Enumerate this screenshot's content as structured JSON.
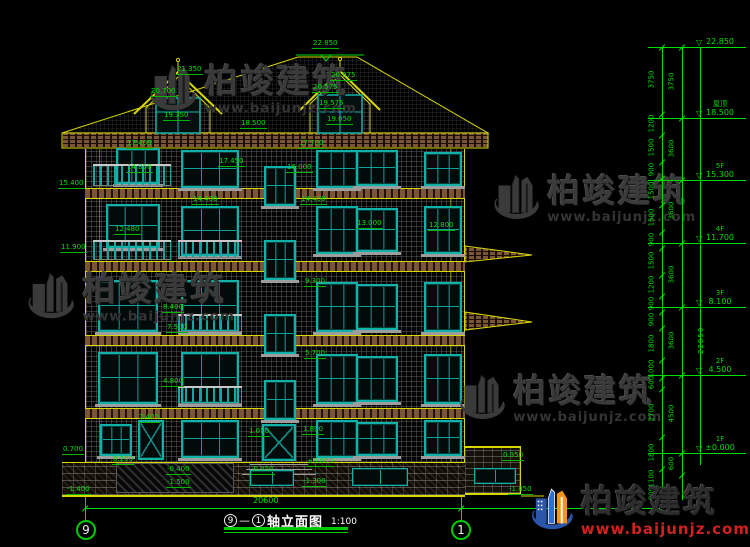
{
  "brand": {
    "name": "柏竣建筑",
    "url": "www.baijunjz.com"
  },
  "title": {
    "axis_from": "9",
    "dash": "—",
    "axis_to": "1",
    "text": "轴立面图",
    "scale": "1:100"
  },
  "axis_bubbles": {
    "left": "9",
    "right": "1"
  },
  "dimensions": {
    "total": "22850",
    "bottom_total": "20600",
    "levels": [
      {
        "floor": "",
        "elev": "22.850",
        "y": 47
      },
      {
        "floor": "屋顶",
        "elev": "18.500",
        "y": 118
      },
      {
        "floor": "5F",
        "elev": "15.300",
        "y": 180
      },
      {
        "floor": "4F",
        "elev": "11.700",
        "y": 243
      },
      {
        "floor": "3F",
        "elev": "8.100",
        "y": 307
      },
      {
        "floor": "2F",
        "elev": "4.500",
        "y": 375
      },
      {
        "floor": "1F",
        "elev": "±0.000",
        "y": 453
      }
    ],
    "col1": {
      "x": 662,
      "labels": [
        [
          "3750",
          80
        ],
        [
          "1200",
          124
        ],
        [
          "1500",
          148
        ],
        [
          "900",
          170
        ],
        [
          "1500",
          191
        ],
        [
          "1500",
          218
        ],
        [
          "900",
          240
        ],
        [
          "1500",
          261
        ],
        [
          "1200",
          285
        ],
        [
          "900",
          304
        ],
        [
          "900",
          320
        ],
        [
          "1800",
          344
        ],
        [
          "1000",
          369
        ],
        [
          "600",
          383
        ],
        [
          "2700",
          413
        ],
        [
          "1800",
          453
        ],
        [
          "1100",
          479
        ],
        [
          "600",
          494
        ]
      ],
      "ticks": [
        47,
        114,
        135,
        162,
        178,
        205,
        232,
        248,
        275,
        296,
        312,
        328,
        360,
        378,
        389,
        437,
        469,
        489,
        500
      ]
    },
    "col2": {
      "x": 682,
      "labels": [
        [
          "3750",
          82
        ],
        [
          "3600",
          149
        ],
        [
          "3600",
          211
        ],
        [
          "3600",
          275
        ],
        [
          "3600",
          341
        ],
        [
          "4500",
          414
        ],
        [
          "600",
          464
        ]
      ],
      "ticks": [
        47,
        118,
        180,
        243,
        307,
        375,
        453,
        475
      ]
    }
  },
  "annotations": [
    {
      "t": "22.850",
      "x": 312,
      "y": 40
    },
    {
      "t": "21.350",
      "x": 176,
      "y": 66
    },
    {
      "t": "20.700",
      "x": 150,
      "y": 88
    },
    {
      "t": "19.350",
      "x": 163,
      "y": 112
    },
    {
      "t": "20.975",
      "x": 330,
      "y": 72
    },
    {
      "t": "20.575",
      "x": 312,
      "y": 84
    },
    {
      "t": "19.575",
      "x": 318,
      "y": 100
    },
    {
      "t": "19.050",
      "x": 326,
      "y": 116
    },
    {
      "t": "18.500",
      "x": 240,
      "y": 120
    },
    {
      "t": "17.400",
      "x": 126,
      "y": 140
    },
    {
      "t": "17.700",
      "x": 298,
      "y": 140
    },
    {
      "t": "17.450",
      "x": 218,
      "y": 158
    },
    {
      "t": "16.000",
      "x": 286,
      "y": 164
    },
    {
      "t": "15.400",
      "x": 58,
      "y": 180
    },
    {
      "t": "14.850",
      "x": 126,
      "y": 164
    },
    {
      "t": "14.400",
      "x": 192,
      "y": 196
    },
    {
      "t": "14.400",
      "x": 300,
      "y": 196
    },
    {
      "t": "13.000",
      "x": 356,
      "y": 220
    },
    {
      "t": "12.800",
      "x": 428,
      "y": 222
    },
    {
      "t": "12.480",
      "x": 114,
      "y": 226
    },
    {
      "t": "11.900",
      "x": 60,
      "y": 244
    },
    {
      "t": "9.300",
      "x": 304,
      "y": 278
    },
    {
      "t": "8.400",
      "x": 162,
      "y": 304
    },
    {
      "t": "7.500",
      "x": 166,
      "y": 324
    },
    {
      "t": "5.700",
      "x": 304,
      "y": 350
    },
    {
      "t": "4.800",
      "x": 162,
      "y": 378
    },
    {
      "t": "2.400",
      "x": 138,
      "y": 414
    },
    {
      "t": "1.800",
      "x": 302,
      "y": 426
    },
    {
      "t": "1.050",
      "x": 248,
      "y": 428
    },
    {
      "t": "0.950",
      "x": 502,
      "y": 452
    },
    {
      "t": "0.700",
      "x": 62,
      "y": 446
    },
    {
      "t": "0.200",
      "x": 112,
      "y": 456
    },
    {
      "t": "±0.000",
      "x": 306,
      "y": 458
    },
    {
      "t": "-0.400",
      "x": 166,
      "y": 466
    },
    {
      "t": "-0.450",
      "x": 250,
      "y": 466
    },
    {
      "t": "-1.300",
      "x": 302,
      "y": 478
    },
    {
      "t": "-1.500",
      "x": 166,
      "y": 479
    },
    {
      "t": "-1.400",
      "x": 66,
      "y": 486
    },
    {
      "t": "-1.450",
      "x": 508,
      "y": 486
    }
  ],
  "facade": {
    "windows": [
      {
        "x": 116,
        "y": 148,
        "w": 44,
        "h": 36,
        "k": "win"
      },
      {
        "x": 181,
        "y": 150,
        "w": 58,
        "h": 38,
        "k": "win"
      },
      {
        "x": 264,
        "y": 166,
        "w": 32,
        "h": 40,
        "k": "win"
      },
      {
        "x": 316,
        "y": 150,
        "w": 42,
        "h": 38,
        "k": "win"
      },
      {
        "x": 356,
        "y": 150,
        "w": 42,
        "h": 36,
        "k": "win"
      },
      {
        "x": 424,
        "y": 152,
        "w": 38,
        "h": 34,
        "k": "win"
      },
      {
        "x": 106,
        "y": 204,
        "w": 54,
        "h": 44,
        "k": "win"
      },
      {
        "x": 181,
        "y": 206,
        "w": 58,
        "h": 50,
        "k": "win"
      },
      {
        "x": 264,
        "y": 240,
        "w": 32,
        "h": 40,
        "k": "win"
      },
      {
        "x": 316,
        "y": 206,
        "w": 42,
        "h": 48,
        "k": "win"
      },
      {
        "x": 356,
        "y": 208,
        "w": 42,
        "h": 44,
        "k": "win"
      },
      {
        "x": 424,
        "y": 206,
        "w": 38,
        "h": 48,
        "k": "win"
      },
      {
        "x": 98,
        "y": 280,
        "w": 60,
        "h": 52,
        "k": "win"
      },
      {
        "x": 181,
        "y": 280,
        "w": 58,
        "h": 52,
        "k": "win"
      },
      {
        "x": 264,
        "y": 314,
        "w": 32,
        "h": 40,
        "k": "win"
      },
      {
        "x": 316,
        "y": 282,
        "w": 42,
        "h": 50,
        "k": "win"
      },
      {
        "x": 356,
        "y": 284,
        "w": 42,
        "h": 46,
        "k": "win"
      },
      {
        "x": 424,
        "y": 282,
        "w": 38,
        "h": 50,
        "k": "win"
      },
      {
        "x": 98,
        "y": 352,
        "w": 60,
        "h": 52,
        "k": "win"
      },
      {
        "x": 181,
        "y": 352,
        "w": 58,
        "h": 52,
        "k": "win"
      },
      {
        "x": 264,
        "y": 380,
        "w": 32,
        "h": 40,
        "k": "win"
      },
      {
        "x": 316,
        "y": 354,
        "w": 42,
        "h": 50,
        "k": "win"
      },
      {
        "x": 356,
        "y": 356,
        "w": 42,
        "h": 46,
        "k": "win"
      },
      {
        "x": 424,
        "y": 354,
        "w": 38,
        "h": 50,
        "k": "win"
      },
      {
        "x": 100,
        "y": 424,
        "w": 32,
        "h": 32,
        "k": "win"
      },
      {
        "x": 138,
        "y": 420,
        "w": 26,
        "h": 40,
        "k": "door"
      },
      {
        "x": 181,
        "y": 420,
        "w": 58,
        "h": 38,
        "k": "win"
      },
      {
        "x": 262,
        "y": 424,
        "w": 34,
        "h": 37,
        "k": "door"
      },
      {
        "x": 316,
        "y": 420,
        "w": 42,
        "h": 38,
        "k": "win"
      },
      {
        "x": 356,
        "y": 422,
        "w": 42,
        "h": 34,
        "k": "win"
      },
      {
        "x": 424,
        "y": 420,
        "w": 38,
        "h": 36,
        "k": "win"
      },
      {
        "x": 250,
        "y": 470,
        "w": 44,
        "h": 16,
        "k": "bwin"
      },
      {
        "x": 352,
        "y": 468,
        "w": 56,
        "h": 18,
        "k": "bwin"
      },
      {
        "x": 474,
        "y": 468,
        "w": 42,
        "h": 16,
        "k": "bwin"
      }
    ],
    "rails": [
      {
        "x": 93,
        "y": 164,
        "w": 78,
        "h": 22
      },
      {
        "x": 93,
        "y": 240,
        "w": 78,
        "h": 20
      },
      {
        "x": 178,
        "y": 240,
        "w": 64,
        "h": 18
      },
      {
        "x": 178,
        "y": 314,
        "w": 64,
        "h": 18
      },
      {
        "x": 178,
        "y": 386,
        "w": 64,
        "h": 18
      }
    ],
    "hatch": {
      "x": 116,
      "y": 463,
      "w": 118,
      "h": 30
    }
  },
  "watermarks": [
    {
      "x": 146,
      "y": 54,
      "s": 0.9
    },
    {
      "x": 490,
      "y": 164,
      "s": 0.88
    },
    {
      "x": 24,
      "y": 262,
      "s": 0.9
    },
    {
      "x": 456,
      "y": 364,
      "s": 0.88
    }
  ]
}
